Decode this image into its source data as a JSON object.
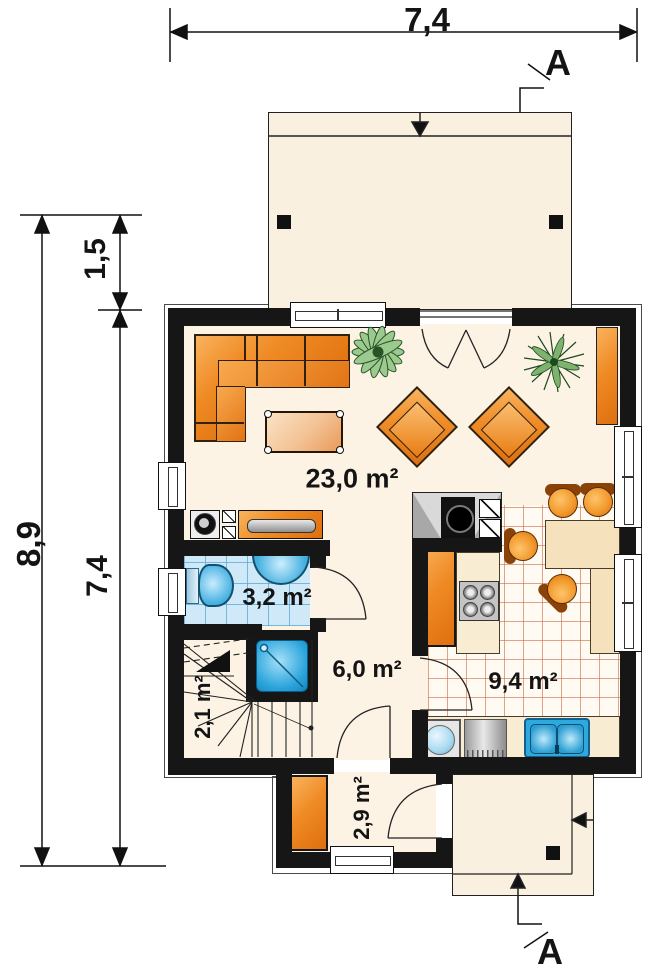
{
  "title": "Ground floor plan",
  "rooms": {
    "living": {
      "name": "living-room",
      "area": "23,0 m²"
    },
    "bathroom": {
      "name": "bathroom",
      "area": "3,2 m²"
    },
    "hall": {
      "name": "hall",
      "area": "6,0 m²"
    },
    "kitchen": {
      "name": "kitchen",
      "area": "9,4 m²"
    },
    "stairs": {
      "name": "staircase",
      "area": "2,1 m²"
    },
    "vestibule": {
      "name": "vestibule",
      "area": "2,9 m²"
    }
  },
  "dimensions": {
    "top_width": "7,4",
    "left_total": "8,9",
    "terrace_depth": "1,5",
    "house_depth": "7,4"
  },
  "section_markers": {
    "top": "A",
    "bottom": "A"
  },
  "palette": {
    "wall": "#161616",
    "floor_cream": "#fdf3e5",
    "furniture_orange": "#ef8b25",
    "bath_tile_blue": "#cfe9f8",
    "fixture_blue": "#35aede",
    "kitchen_tile_line": "#cd6941",
    "plant_green": "#8cc08a"
  }
}
